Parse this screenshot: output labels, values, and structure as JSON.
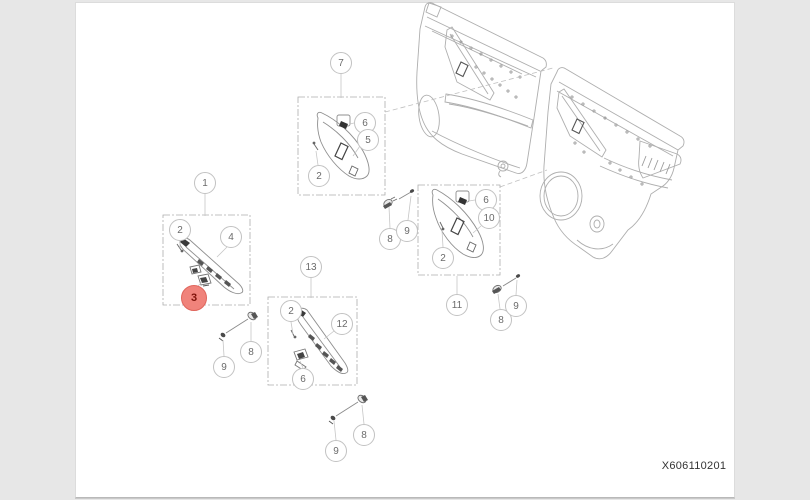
{
  "page": {
    "part_number_label": "X606110201"
  },
  "colors": {
    "callout_border": "#c2c2c2",
    "callout_text": "#6b6b6b",
    "highlight_fill": "#f0837b",
    "highlight_border": "#e0655c",
    "highlight_text": "#7f1209",
    "line_art": "#aeaeae",
    "part_line": "#8f8f8f"
  },
  "diagram": {
    "description": "Exploded parts diagram of front and rear door trim panels with numbered callouts",
    "callouts": [
      {
        "label": "1",
        "highlighted": false
      },
      {
        "label": "2",
        "highlighted": false
      },
      {
        "label": "4",
        "highlighted": false
      },
      {
        "label": "3",
        "highlighted": true
      },
      {
        "label": "7",
        "highlighted": false
      },
      {
        "label": "6",
        "highlighted": false
      },
      {
        "label": "5",
        "highlighted": false
      },
      {
        "label": "2",
        "highlighted": false
      },
      {
        "label": "8",
        "highlighted": false
      },
      {
        "label": "9",
        "highlighted": false
      },
      {
        "label": "13",
        "highlighted": false
      },
      {
        "label": "2",
        "highlighted": false
      },
      {
        "label": "12",
        "highlighted": false
      },
      {
        "label": "6",
        "highlighted": false
      },
      {
        "label": "9",
        "highlighted": false
      },
      {
        "label": "8",
        "highlighted": false
      },
      {
        "label": "6",
        "highlighted": false
      },
      {
        "label": "10",
        "highlighted": false
      },
      {
        "label": "2",
        "highlighted": false
      },
      {
        "label": "11",
        "highlighted": false
      },
      {
        "label": "9",
        "highlighted": false
      },
      {
        "label": "8",
        "highlighted": false
      },
      {
        "label": "8",
        "highlighted": false
      },
      {
        "label": "9",
        "highlighted": false
      }
    ]
  }
}
